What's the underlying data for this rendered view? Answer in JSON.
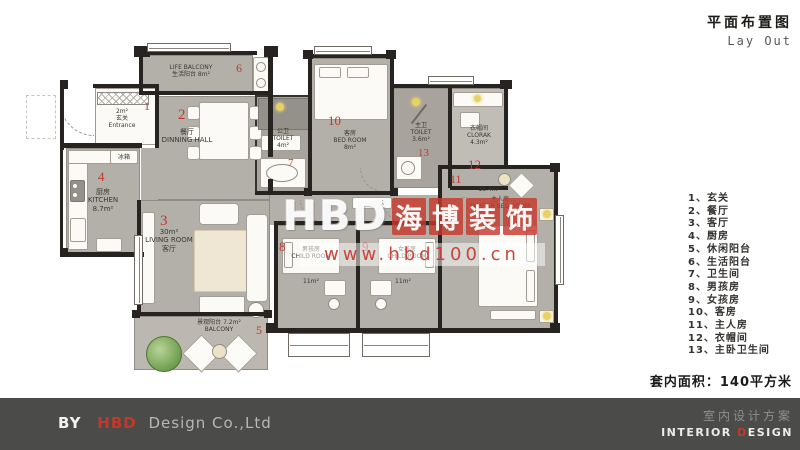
{
  "header": {
    "title_cn": "平面布置图",
    "title_en": "Lay Out"
  },
  "legend": {
    "items": [
      "1、玄关",
      "2、餐厅",
      "3、客厅",
      "4、厨房",
      "5、休闲阳台",
      "6、生活阳台",
      "7、卫生间",
      "8、男孩房",
      "9、女孩房",
      "10、客房",
      "11、主人房",
      "12、衣帽间",
      "13、主卧卫生间"
    ]
  },
  "area_note": "套内面积：140平方米",
  "watermark": {
    "brand": "HBD",
    "chars": [
      "海",
      "博",
      "装",
      "饰"
    ],
    "url": "www.hbd100.cn"
  },
  "footer": {
    "by": "BY",
    "brand": "HBD",
    "company": "Design Co.,Ltd",
    "right_cn": "室内设计方案",
    "right_en_a": "INTERIOR ",
    "right_en_b": "D",
    "right_en_c": "ESIGN"
  },
  "plan": {
    "rooms": {
      "life_balcony": {
        "num": "6",
        "en": "LIFE BALCONY",
        "cn": "生活阳台",
        "area": "8m²"
      },
      "entrance": {
        "num": "1",
        "area": "2m²",
        "cn": "玄关",
        "en": "Entrance"
      },
      "dining": {
        "num": "2",
        "cn": "餐厅",
        "en": "DINNING HALL"
      },
      "kitchen": {
        "num": "4",
        "cn": "厨房",
        "en": "KITCHEN",
        "area": "8.7m²"
      },
      "living": {
        "num": "3",
        "area": "30m²",
        "en": "LIVING ROOM",
        "cn": "客厅"
      },
      "balcony": {
        "num": "5",
        "cn": "景观阳台",
        "area": "7.2m²",
        "en": "BALCONY"
      },
      "toilet_public": {
        "num": "7",
        "cn": "公卫",
        "en": "TOILET",
        "area": "4m²"
      },
      "guest": {
        "num": "10",
        "cn": "客房",
        "en": "BED ROOM",
        "area": "8m²"
      },
      "toilet_master": {
        "num": "13",
        "cn": "主卫",
        "en": "TOILET",
        "area": "3.6m²"
      },
      "cloak": {
        "num": "12",
        "cn": "衣帽间",
        "en": "CLORAK",
        "area": "4.3m²"
      },
      "master": {
        "num": "11",
        "area": "18.4m²",
        "cn": "主人房",
        "en": "MASTER BED ROOM"
      },
      "boy": {
        "num": "8",
        "cn": "男孩房",
        "en": "CHILD ROOM",
        "area": "11m²"
      },
      "girl": {
        "num": "9",
        "cn": "女孩房",
        "en": "CHILD ROOM",
        "area": "11m²"
      },
      "fridge_label": "冰箱"
    },
    "colors": {
      "room_fill": "#b3b0aa",
      "wall": "#262320",
      "accent_red": "#c0392b"
    }
  }
}
